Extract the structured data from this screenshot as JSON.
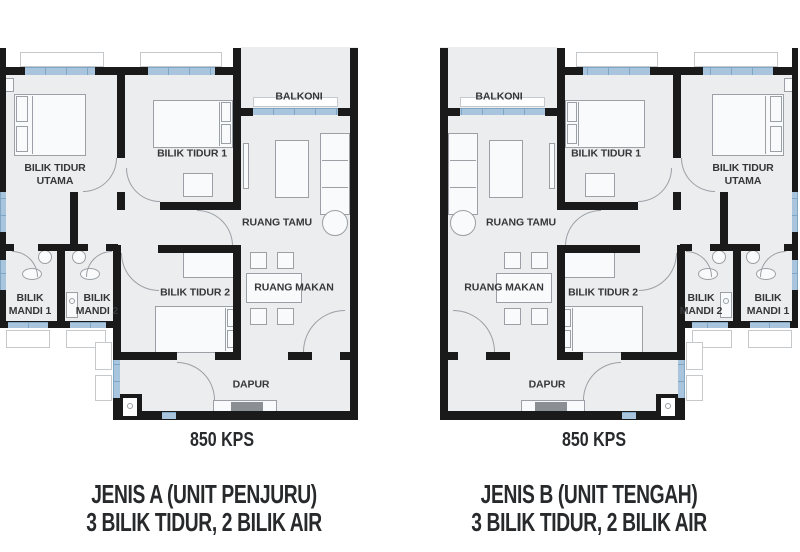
{
  "colors": {
    "wall": "#1a1a1a",
    "floor": "#ecedef",
    "window": "#a9c5dd",
    "window_edge": "#7fa6c4",
    "line": "#9aa0a5",
    "label_text": "#35373a",
    "caption_text": "#27292b",
    "background": "#ffffff"
  },
  "plans": [
    {
      "id": "A",
      "area_label": "850 KPS",
      "caption_line1": "JENIS A (UNIT PENJURU)",
      "caption_line2": "3 BILIK TIDUR, 2 BILIK AIR",
      "rooms": {
        "balkoni": "BALKONI",
        "bilik_tidur_utama": "BILIK TIDUR UTAMA",
        "bilik_tidur_1": "BILIK TIDUR 1",
        "bilik_tidur_2": "BILIK TIDUR 2",
        "ruang_tamu": "RUANG TAMU",
        "ruang_makan": "RUANG MAKAN",
        "bilik_mandi_1": "BILIK MANDI 1",
        "bilik_mandi_2": "BILIK MANDI 2",
        "dapur": "DAPUR"
      }
    },
    {
      "id": "B",
      "area_label": "850 KPS",
      "caption_line1": "JENIS B (UNIT TENGAH)",
      "caption_line2": "3 BILIK TIDUR, 2 BILIK AIR",
      "rooms": {
        "balkoni": "BALKONI",
        "bilik_tidur_utama": "BILIK TIDUR UTAMA",
        "bilik_tidur_1": "BILIK TIDUR 1",
        "bilik_tidur_2": "BILIK TIDUR 2",
        "ruang_tamu": "RUANG TAMU",
        "ruang_makan": "RUANG MAKAN",
        "bilik_mandi_1": "BILIK MANDI 1",
        "bilik_mandi_2": "BILIK MANDI 2",
        "dapur": "DAPUR"
      }
    }
  ]
}
